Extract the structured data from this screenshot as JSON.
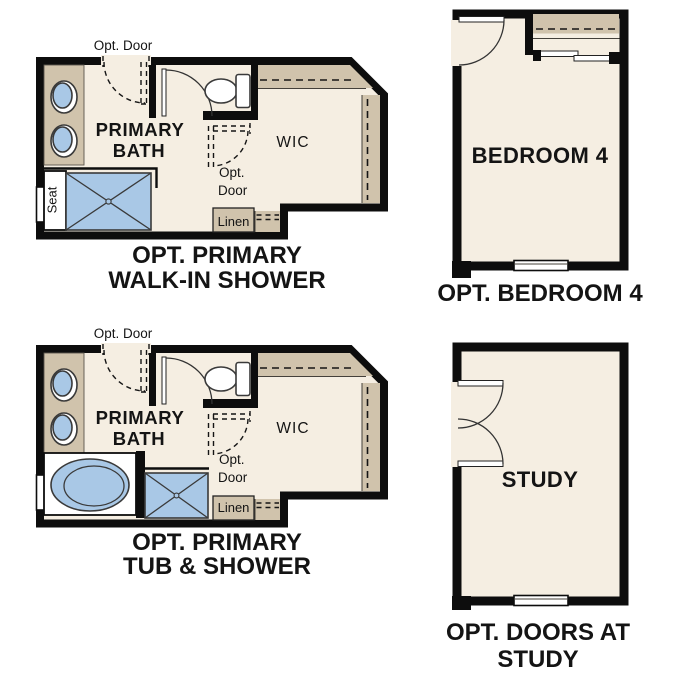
{
  "colors": {
    "page": "#ffffff",
    "wall": "#0d0d0d",
    "floor": "#f5eee2",
    "tan": "#d0c3ac",
    "blue": "#a9c8e6"
  },
  "plans": {
    "walk_in_shower": {
      "opt_door_top": "Opt. Door",
      "room_line1": "PRIMARY",
      "room_line2": "BATH",
      "closet": "WIC",
      "closet_door_line1": "Opt.",
      "closet_door_line2": "Door",
      "linen": "Linen",
      "seat": "Seat",
      "caption_line1": "OPT. PRIMARY",
      "caption_line2": "WALK-IN SHOWER"
    },
    "tub_shower": {
      "opt_door_top": "Opt. Door",
      "room_line1": "PRIMARY",
      "room_line2": "BATH",
      "closet": "WIC",
      "closet_door_line1": "Opt.",
      "closet_door_line2": "Door",
      "linen": "Linen",
      "caption_line1": "OPT. PRIMARY",
      "caption_line2": "TUB & SHOWER"
    },
    "bedroom4": {
      "room": "BEDROOM 4",
      "caption": "OPT. BEDROOM 4"
    },
    "study": {
      "room": "STUDY",
      "caption_line1": "OPT. DOORS AT",
      "caption_line2": "STUDY"
    }
  }
}
